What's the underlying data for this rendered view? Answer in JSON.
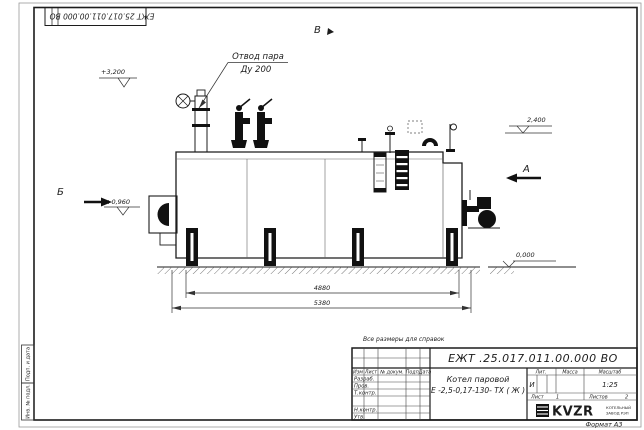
{
  "drawing": {
    "top_stamp_number": "ЕЖТ 25.017.011.00.000  ВО",
    "note": "Все размеры для справок",
    "leader": {
      "line1": "Отвод пара",
      "line2": "Ду 200"
    },
    "views": {
      "top": "В",
      "left": "Б",
      "right": "А"
    },
    "elevations": {
      "valves_top": "+3,200",
      "drum_right": "2,400",
      "burner_axis": "+0,960",
      "ground": "0,000"
    },
    "dimensions": {
      "supports_span": "4880",
      "overall_length": "5380"
    }
  },
  "title_block": {
    "doc_number": "ЕЖТ .25.017.011.00.000  ВО",
    "product_name_line1": "Котел паровой",
    "product_name_line2": "Е -2,5-0,17-130- ТХ ( Ж )",
    "columns": {
      "izm": "Изм",
      "list": "Лист",
      "docnum": "№ докум.",
      "podp": "Подп.",
      "data": "Дата"
    },
    "roles": {
      "razrab": "Разраб.",
      "prov": "Пров.",
      "tkontr": "Т.контр.",
      "nkontr": "Н.контр.",
      "utv": "Утв."
    },
    "lit": {
      "label": "Лит.",
      "value": "И"
    },
    "mass": {
      "label": "Масса",
      "value": ""
    },
    "scale": {
      "label": "Масштаб",
      "value": "1:25"
    },
    "sheet": {
      "label": "Лист",
      "value": "1"
    },
    "sheets": {
      "label": "Листов",
      "value": "2"
    },
    "logo": {
      "text": "KVZR",
      "caption_line1": "КОТЕЛЬНЫЙ",
      "caption_line2": "ЗАВОД РЭП"
    },
    "format": "Формат А3"
  },
  "margin": {
    "stamp1": "Подп. и дата",
    "stamp2": "Инв. № подл."
  },
  "colors": {
    "line": "#1c1c1c",
    "thin": "#555555",
    "paper": "#ffffff"
  }
}
